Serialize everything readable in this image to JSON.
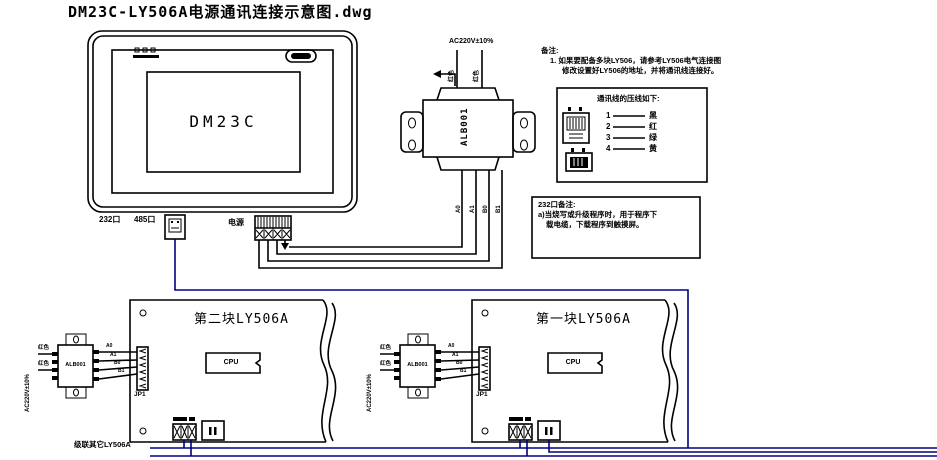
{
  "title": "DM23C-LY506A电源通讯连接示意图.dwg",
  "panel": {
    "screen_label": "DM23C",
    "port_232_label": "232口",
    "port_485_label": "485口",
    "power_label": "电源"
  },
  "transformer": {
    "label": "ALB001",
    "input_voltage": "AC220V±10%",
    "wire_red_1": "红色",
    "wire_red_2": "红色",
    "pin_a0": "A0",
    "pin_a1": "A1",
    "pin_b0": "B0",
    "pin_b1": "B1"
  },
  "remarks": {
    "heading": "备注:",
    "line1": "1. 如果要配备多块LY506，请参考LY506电气连接图",
    "line2": "修改设置好LY506的地址，并将通讯线连接好。"
  },
  "pinout": {
    "title": "通讯线的压线如下:",
    "rows": [
      {
        "num": "1",
        "color": "黑"
      },
      {
        "num": "2",
        "color": "红"
      },
      {
        "num": "3",
        "color": "绿"
      },
      {
        "num": "4",
        "color": "黄"
      }
    ]
  },
  "note232": {
    "line1": "232口备注:",
    "line2": "a)当烧写或升级程序时，用于程序下",
    "line3": "载电缆，下载程序到触摸屏。"
  },
  "boards": [
    {
      "title": "第二块LY506A",
      "cpu_label": "CPU",
      "connector_label": "JP1",
      "transformer_label": "ALB001",
      "voltage_label": "AC220V±10%",
      "wire_red_1": "红色",
      "wire_red_2": "红色",
      "pin_a0": "A0",
      "pin_a1": "A1",
      "pin_b0": "B0",
      "pin_b1": "B1"
    },
    {
      "title": "第一块LY506A",
      "cpu_label": "CPU",
      "connector_label": "JP1",
      "transformer_label": "ALB001",
      "voltage_label": "AC220V±10%",
      "wire_red_1": "红色",
      "wire_red_2": "红色",
      "pin_a0": "A0",
      "pin_a1": "A1",
      "pin_b0": "B0",
      "pin_b1": "B1"
    }
  ],
  "cascade_label": "级联其它LY506A",
  "colors": {
    "line": "#000000",
    "comm_wire": "#000080",
    "background": "#FFFFFF"
  }
}
